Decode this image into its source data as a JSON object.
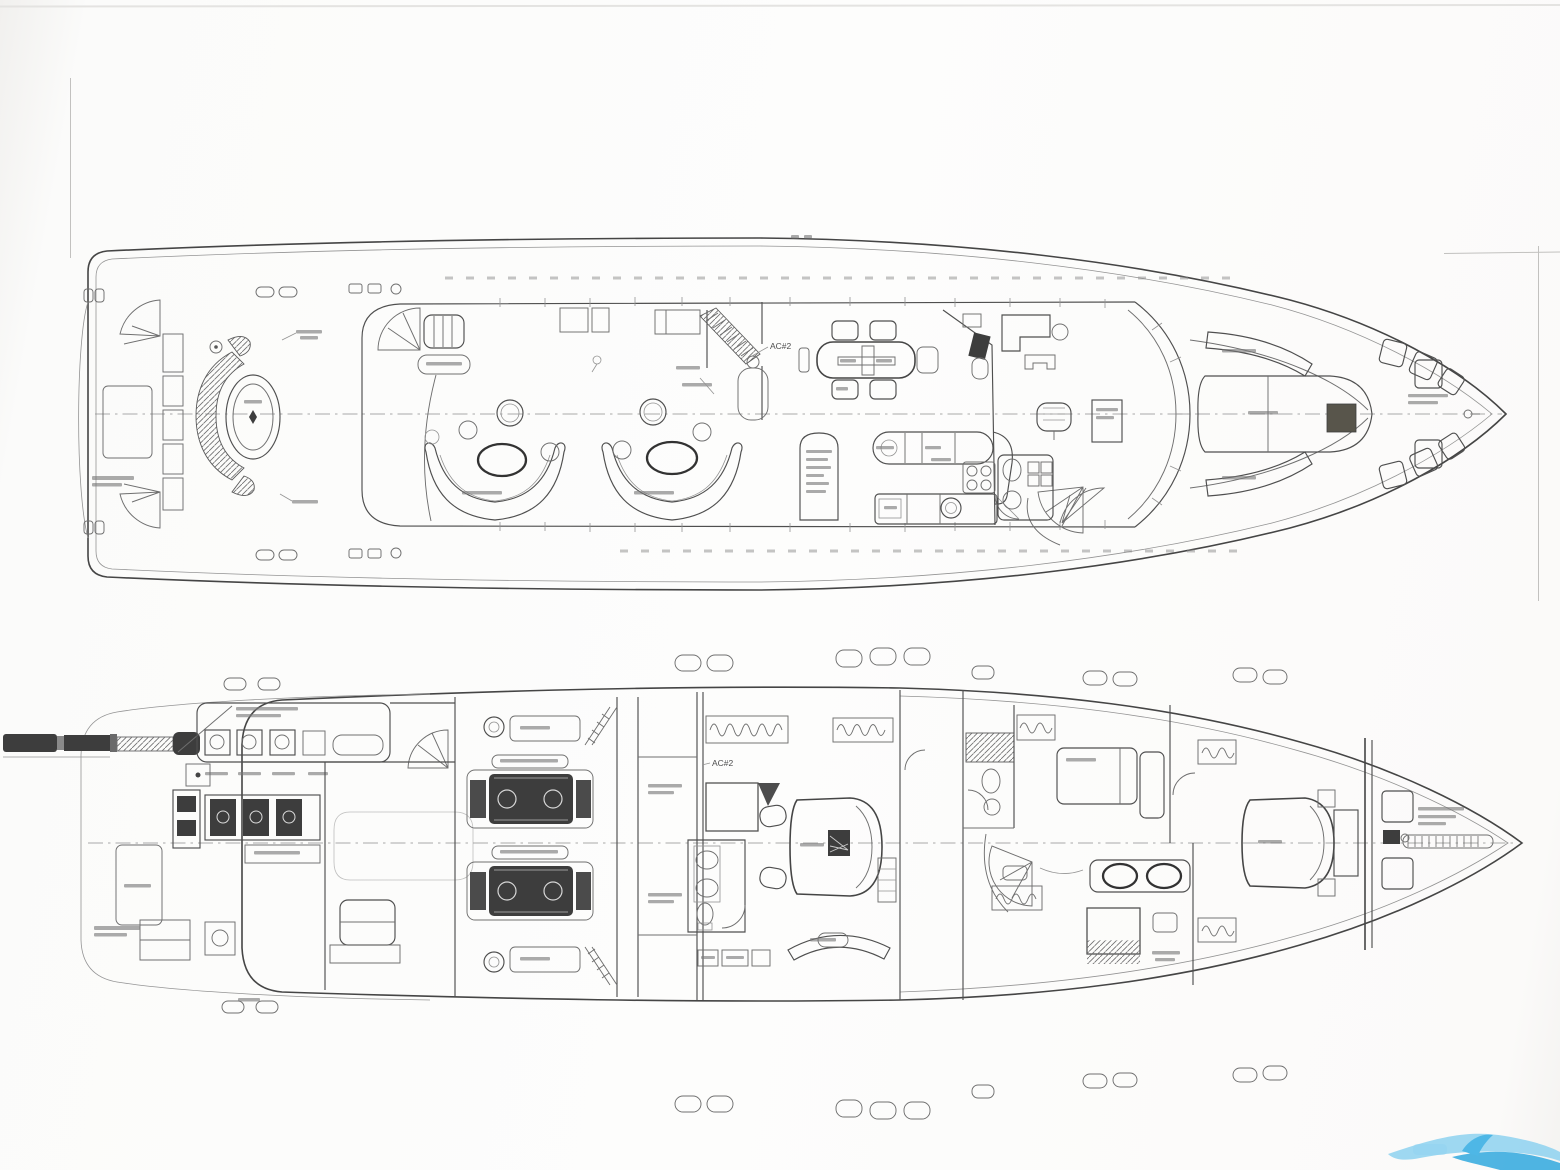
{
  "plans": {
    "main_deck": {
      "ac_label": "AC#2"
    },
    "lower_deck": {
      "ac_label": "AC#2"
    }
  },
  "watermark": {
    "light_color": "#8ed4f2",
    "mid_color": "#4db8e8",
    "dark_color": "#2fa9e0"
  }
}
